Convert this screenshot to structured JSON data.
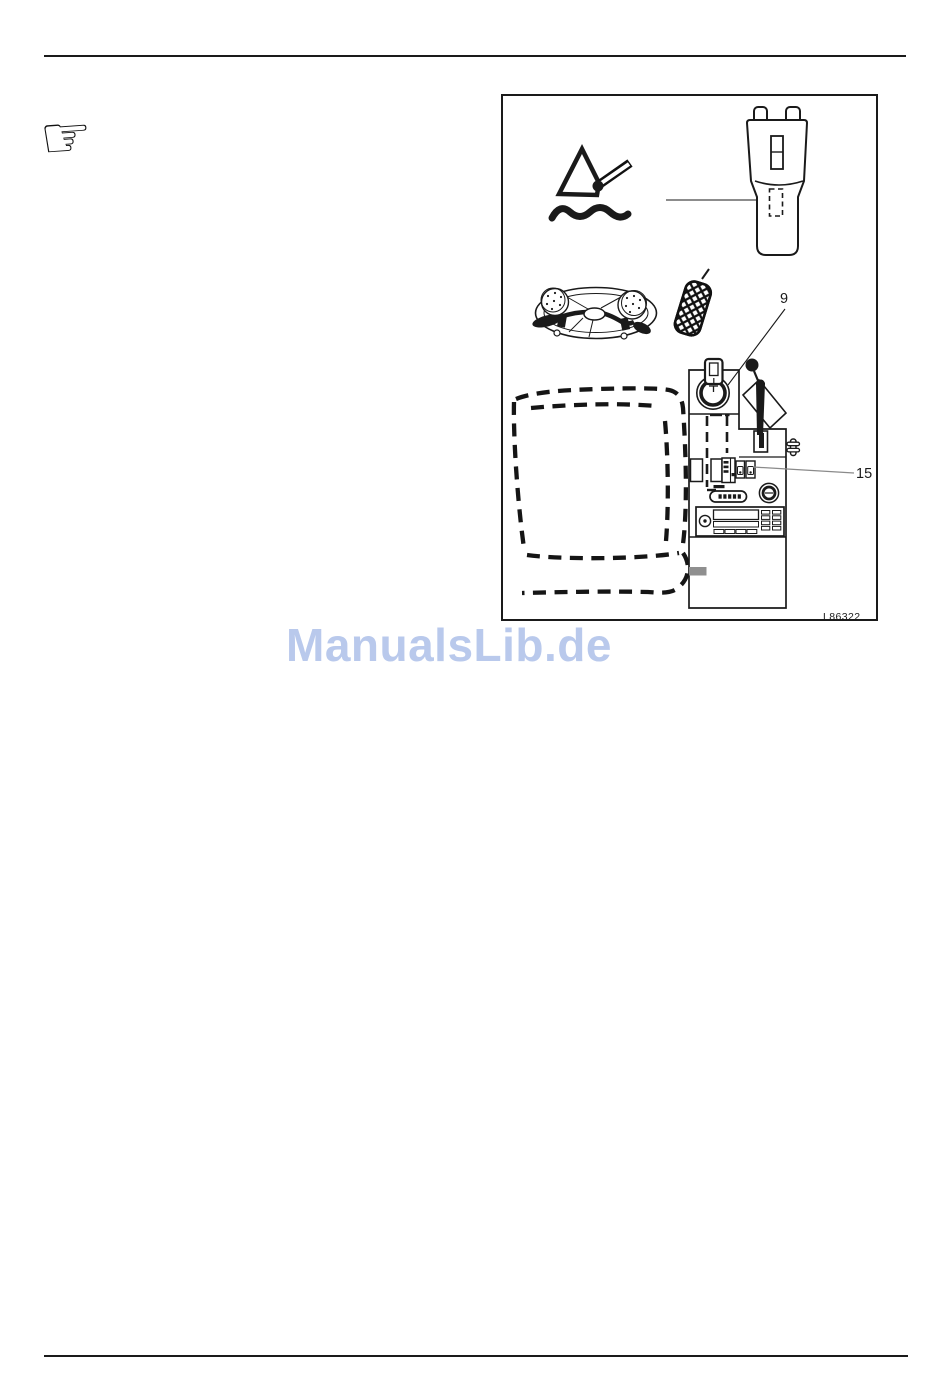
{
  "page": {
    "background": "#ffffff"
  },
  "manicule": {
    "glyph": "☞",
    "meaning": "pointing-hand-note-marker"
  },
  "figure": {
    "callouts": {
      "ignition": "9",
      "switch_panel": "15"
    },
    "code": "L86322",
    "icons": [
      "seat-recline-pictogram",
      "wave-line",
      "headrest",
      "pointer-line",
      "steering-wheel",
      "accelerator-pedal",
      "driver-seat-outline",
      "center-console",
      "ignition-key-switch",
      "gear-lever",
      "handbrake-lever",
      "switch-panel",
      "heater-slider",
      "cigarette-lighter",
      "car-radio",
      "fastener-screw"
    ]
  },
  "watermark": {
    "text": "ManualsLib.de",
    "color": "#b9c9ec"
  }
}
